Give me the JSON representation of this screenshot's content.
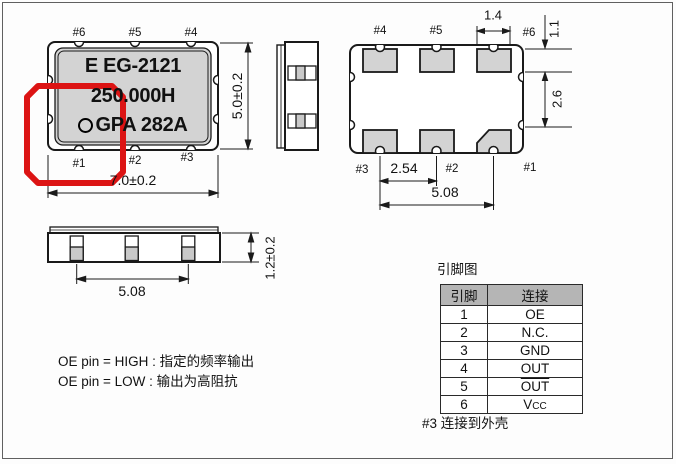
{
  "top_view": {
    "marking": {
      "line1": "E EG-2121",
      "line2": "250.000H",
      "line3": "GPA 282A"
    },
    "pins_top": [
      "#6",
      "#5",
      "#4"
    ],
    "pins_bottom": [
      "#1",
      "#2",
      "#3"
    ],
    "dim_width": "7.0±0.2",
    "dim_height": "5.0±0.2"
  },
  "pad_view": {
    "pins_top": [
      "#4",
      "#5",
      "#6"
    ],
    "pins_bottom": [
      "#3",
      "#2",
      "#1"
    ],
    "dim_pad_width": "1.4",
    "dim_pad_height": "1.1",
    "dim_row_gap": "2.6",
    "dim_pitch": "2.54",
    "dim_span": "5.08"
  },
  "side_view": {
    "dim_span": "5.08",
    "dim_thickness": "1.2±0.2"
  },
  "pin_table": {
    "title": "引脚图",
    "headers": [
      "引脚",
      "连接"
    ],
    "rows": [
      {
        "pin": "1",
        "conn": "OE"
      },
      {
        "pin": "2",
        "conn": "N.C."
      },
      {
        "pin": "3",
        "conn": "GND"
      },
      {
        "pin": "4",
        "conn": "OUT"
      },
      {
        "pin": "5",
        "conn": "OUT",
        "overline": true
      },
      {
        "pin": "6",
        "conn": "V",
        "conn_sub": "CC"
      }
    ],
    "footnote": "#3 连接到外壳"
  },
  "notes": {
    "line1": "OE pin = HIGH : 指定的频率输出",
    "line2": "OE pin = LOW : 输出为高阻抗"
  },
  "colors": {
    "annotation": "#dc1414",
    "line": "#1a1a1a",
    "package_fill": "#d3d3d3",
    "table_header": "#b5b5b5"
  }
}
